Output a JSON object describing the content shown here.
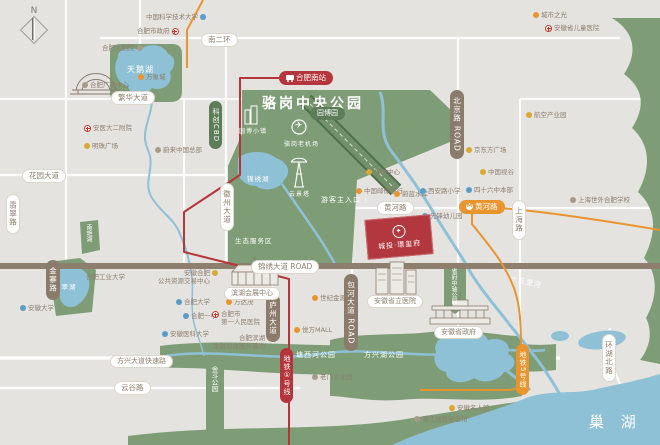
{
  "compass": {
    "label": "N"
  },
  "icons": {
    "metro_m": "M",
    "plane": "✈",
    "emblem": "✦"
  },
  "park": {
    "title": "骆岗中央公园",
    "badge": "园博园",
    "cbd_pill": "科创CBD",
    "town": "园博小镇",
    "tower": "云景塔",
    "airport": "骆岗老机场",
    "lake": "锦绣湖",
    "eco_zone": "生态服务区",
    "entrance": "游客主入口 ›"
  },
  "waters": {
    "swan_lake": "天鹅湖",
    "feicui_lake": "翡翠湖",
    "nanyan_lake": "南艳湖",
    "shiwuli_river": "十五里河",
    "chao_lake": "巢 湖"
  },
  "green_spaces": {
    "tangxihe": "塘西河公园",
    "fangxinghu": "方兴湖公园",
    "jindou": "金斗公园",
    "shengfu_axis": "省府中轴公园"
  },
  "roads": {
    "nanerhuan": "南二环",
    "fanhua": "繁华大道",
    "huayuan": "花园大道",
    "huanghe": "黄河路",
    "jinxiu": "锦绣大道 ROAD",
    "fangxing": "方兴大道快速路",
    "yungu": "云谷路",
    "feicui": "翡翠路",
    "jinzhai": "金寨路",
    "huizhou": "徽州大道",
    "luzhou": "庐州大道",
    "baohe": "包河大道 ROAD",
    "beijing": "北京路 ROAD",
    "shanghai": "上海路",
    "huanhubei": "环湖北路"
  },
  "metro": {
    "south_station": "合肥南站",
    "line1": "地铁①号线",
    "line5": "地铁5号线",
    "huanghe_station": "黄河路"
  },
  "landmarks": {
    "exhibition": "滨湖会展中心",
    "hospital": "安徽省立医院",
    "government": "安徽省政府"
  },
  "project": {
    "name": "城投·璟玺府"
  },
  "pois": [
    {
      "label": "中国科学技术大学"
    },
    {
      "label": "合肥市政府"
    },
    {
      "label": "合肥大剧院"
    },
    {
      "label": "万象城"
    },
    {
      "label": "合肥广电中心"
    },
    {
      "label": "安医大二附院"
    },
    {
      "label": "明珠广场"
    },
    {
      "label": "蔚来中国总部"
    },
    {
      "label": "安徽大学"
    },
    {
      "label": "合肥工业大学"
    },
    {
      "label": "安徽合肥",
      "label2": "公共资源交易中心"
    },
    {
      "label": "合肥大学"
    },
    {
      "label": "合肥一中"
    },
    {
      "label": "安徽医科大学"
    },
    {
      "label": "栢悦中心"
    },
    {
      "label": "中国邮储银行"
    },
    {
      "label": "蔚蓝水岸"
    },
    {
      "label": "西安路小学"
    },
    {
      "label": "先锋幼儿园"
    },
    {
      "label": "四十六中本部"
    },
    {
      "label": "中国视谷"
    },
    {
      "label": "京东方广场"
    },
    {
      "label": "航空产业园"
    },
    {
      "label": "城市之光"
    },
    {
      "label": "安徽省儿童医院"
    },
    {
      "label": "上海世外合肥学校"
    },
    {
      "label": "万达茂"
    },
    {
      "label": "合肥市",
      "label2": "第一人民医院"
    },
    {
      "label": "合肥滨湖",
      "label2": "金融后台服务基地"
    },
    {
      "label": "世纪金源"
    },
    {
      "label": "悦方MALL"
    },
    {
      "label": "老门文化园"
    },
    {
      "label": "渡江战役纪念馆"
    },
    {
      "label": "安徽名人馆"
    }
  ],
  "colors": {
    "land": "#e4e3e0",
    "park_green": "#7e9d77",
    "water_blue": "#8ec1d6",
    "road_brown": "#8a7b6b",
    "metro_red": "#b5353c",
    "metro_orange": "#e8952f",
    "project_red": "#b2373e"
  }
}
